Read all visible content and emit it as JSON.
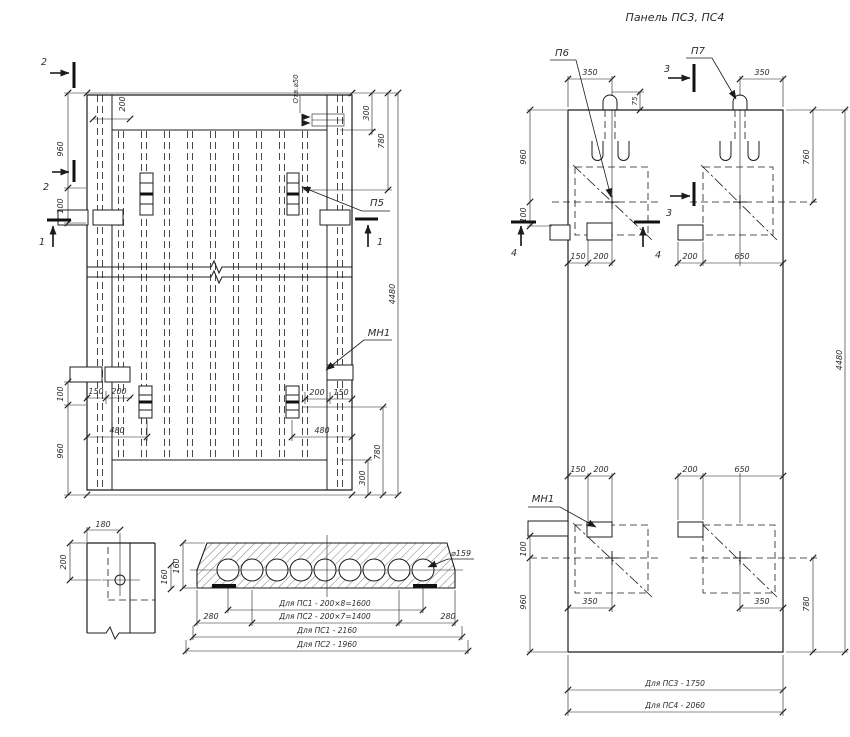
{
  "title": "Панель ПС3, ПС4",
  "plan": {
    "s2_top": "2",
    "s2_side": "2",
    "s1_left": "1",
    "s1_right": "1",
    "hole_label": "Отв.⌀50",
    "p5": "П5",
    "mn1": "МН1",
    "d200_top": "200",
    "d960_tl": "960",
    "d100_tl": "100",
    "d300_tr": "300",
    "d780_tr": "780",
    "d4480": "4480",
    "d150_bl": "150",
    "d200_bl": "200",
    "d480_bl": "480",
    "d200_br": "200",
    "d150_br": "150",
    "d480_br": "480",
    "d100_bl": "100",
    "d960_bl": "960",
    "d780_br": "780",
    "d300_br": "300"
  },
  "corner": {
    "d180": "180",
    "d200": "200",
    "d160": "160"
  },
  "section": {
    "dia": "⌀159",
    "d160": "160",
    "d280_l": "280",
    "d280_r": "280",
    "row_ps1_voids": "Для ПС1 - 200×8=1600",
    "row_ps2_voids": "Для ПС2 - 200×7=1400",
    "row_ps1_len": "Для ПС1 - 2160",
    "row_ps2_len": "Для ПС2 - 1960"
  },
  "elevation": {
    "p6": "П6",
    "p7": "П7",
    "mn1": "МН1",
    "s3_top": "3",
    "s3_mid": "3",
    "s4_left": "4",
    "s4_right": "4",
    "d350_tl": "350",
    "d75": "75",
    "d350_tr": "350",
    "d960_tl": "960",
    "d100_tl": "100",
    "d150_tl": "150",
    "d200_tl": "200",
    "d200_tr": "200",
    "d650_tr": "650",
    "d760": "760",
    "d150_bl": "150",
    "d200_bl": "200",
    "d200_br": "200",
    "d650_br": "650",
    "d100_bl": "100",
    "d960_bl": "960",
    "d350_bl": "350",
    "d350_br": "350",
    "d780": "780",
    "d4480": "4480",
    "ps3": "Для ПС3 - 1750",
    "ps4": "Для ПС4 - 2060"
  }
}
